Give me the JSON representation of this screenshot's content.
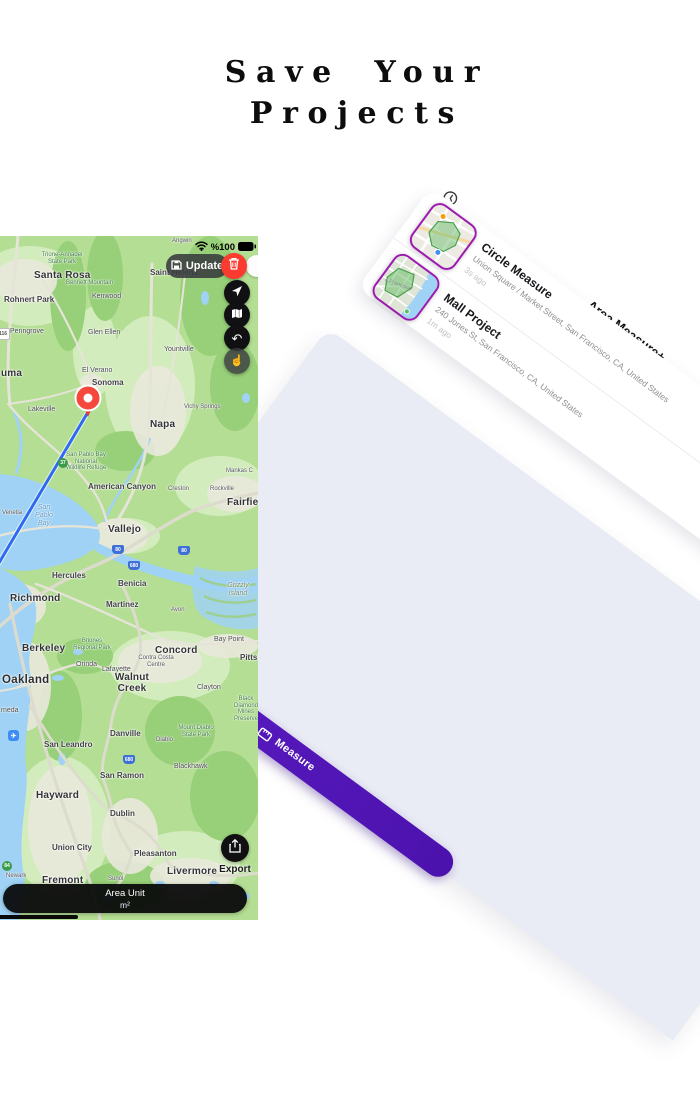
{
  "title": {
    "line1": "Save Your",
    "line2": "Projects"
  },
  "panel": {
    "title": "Area Measure+",
    "history_icon": "clock-history-icon",
    "tab_label": "Measure",
    "tab_icon": "ruler-icon",
    "accent_color": "#5d1ec9",
    "thumb_border_color": "#9c1ab1",
    "background_color": "#e9ebf5",
    "projects": [
      {
        "name": "Circle Measure",
        "address": "Union Square / Market Street, San Francisco, CA, United States",
        "time": "3s ago"
      },
      {
        "name": "Mall Project",
        "address": "240 Jones St, San Francisco, CA, United States",
        "time": "1m ago"
      }
    ]
  },
  "phone": {
    "status": {
      "battery_text": "%100",
      "wifi_icon": "wifi-icon",
      "battery_icon": "battery-full-icon"
    },
    "update_button": {
      "label": "Update",
      "icon": "save-icon"
    },
    "delete_button": {
      "icon": "trash-icon",
      "color": "#fb3b30"
    },
    "controls": [
      {
        "icon": "location-arrow-icon"
      },
      {
        "icon": "map-layers-icon"
      },
      {
        "icon": "undo-icon"
      },
      {
        "icon": "tap-gesture-icon"
      }
    ],
    "export_button": {
      "label": "Export",
      "icon": "share-export-icon"
    },
    "area_unit": {
      "label": "Area Unit",
      "value": "m²"
    },
    "pin_color": "#f5473c",
    "line_color": "#2e6bf0",
    "map_labels": [
      {
        "t": "Santa Rosa",
        "x": 34,
        "y": 34,
        "c": "city-lg"
      },
      {
        "t": "Trione-Annadel\nState Park",
        "x": 62,
        "y": 16,
        "c": "park ctr"
      },
      {
        "t": "Bennett Mountain",
        "x": 66,
        "y": 44,
        "c": "park"
      },
      {
        "t": "Rohnert Park",
        "x": 4,
        "y": 60,
        "c": "city"
      },
      {
        "t": "Kenwood",
        "x": 92,
        "y": 57,
        "c": "town"
      },
      {
        "t": "Penngrove",
        "x": 10,
        "y": 92,
        "c": "town"
      },
      {
        "t": "Glen Ellen",
        "x": 88,
        "y": 93,
        "c": "town"
      },
      {
        "t": "Saint Helena",
        "x": 150,
        "y": 33,
        "c": "city"
      },
      {
        "t": "Angwin",
        "x": 172,
        "y": 2,
        "c": "small"
      },
      {
        "t": "Yountville",
        "x": 164,
        "y": 110,
        "c": "town"
      },
      {
        "t": "El Verano",
        "x": 82,
        "y": 131,
        "c": "town"
      },
      {
        "t": "Sonoma",
        "x": 92,
        "y": 143,
        "c": "city"
      },
      {
        "t": "Lakeville",
        "x": 28,
        "y": 170,
        "c": "town"
      },
      {
        "t": "uma",
        "x": 1,
        "y": 132,
        "c": "city-lg"
      },
      {
        "t": "Napa",
        "x": 150,
        "y": 183,
        "c": "city-lg"
      },
      {
        "t": "Vichy Springs",
        "x": 184,
        "y": 168,
        "c": "small"
      },
      {
        "t": "San Pablo Bay\nNational\nWildlife Refuge",
        "x": 86,
        "y": 216,
        "c": "park ctr"
      },
      {
        "t": "American Canyon",
        "x": 88,
        "y": 247,
        "c": "city"
      },
      {
        "t": "Creston",
        "x": 168,
        "y": 250,
        "c": "small"
      },
      {
        "t": "Rockville",
        "x": 210,
        "y": 250,
        "c": "small"
      },
      {
        "t": "Mankas C",
        "x": 226,
        "y": 232,
        "c": "small"
      },
      {
        "t": "Fairfield",
        "x": 227,
        "y": 261,
        "c": "city-lg"
      },
      {
        "t": "San\nPablo\nBay",
        "x": 44,
        "y": 268,
        "c": "water ctr"
      },
      {
        "t": "Venetia",
        "x": 2,
        "y": 274,
        "c": "small"
      },
      {
        "t": "Vallejo",
        "x": 108,
        "y": 288,
        "c": "city-lg"
      },
      {
        "t": "Hercules",
        "x": 52,
        "y": 336,
        "c": "city"
      },
      {
        "t": "Benicia",
        "x": 118,
        "y": 344,
        "c": "city"
      },
      {
        "t": "Richmond",
        "x": 10,
        "y": 357,
        "c": "city-lg"
      },
      {
        "t": "Martinez",
        "x": 106,
        "y": 365,
        "c": "city"
      },
      {
        "t": "Avon",
        "x": 171,
        "y": 371,
        "c": "small"
      },
      {
        "t": "Grizzly\nIsland",
        "x": 238,
        "y": 346,
        "c": "area ctr"
      },
      {
        "t": "Bay Point",
        "x": 214,
        "y": 400,
        "c": "town"
      },
      {
        "t": "Berkeley",
        "x": 22,
        "y": 407,
        "c": "city-lg"
      },
      {
        "t": "Briones\nRegional Park",
        "x": 92,
        "y": 402,
        "c": "park ctr"
      },
      {
        "t": "Concord",
        "x": 155,
        "y": 409,
        "c": "city-lg"
      },
      {
        "t": "Pittsburg",
        "x": 240,
        "y": 418,
        "c": "city"
      },
      {
        "t": "Orinda",
        "x": 76,
        "y": 425,
        "c": "town"
      },
      {
        "t": "Lafayette",
        "x": 102,
        "y": 430,
        "c": "town"
      },
      {
        "t": "Contra Costa\nCentre",
        "x": 156,
        "y": 419,
        "c": "small ctr"
      },
      {
        "t": "Oakland",
        "x": 2,
        "y": 438,
        "c": "city-xl"
      },
      {
        "t": "Walnut\nCreek",
        "x": 132,
        "y": 436,
        "c": "city-lg ctr"
      },
      {
        "t": "Clayton",
        "x": 197,
        "y": 448,
        "c": "town"
      },
      {
        "t": "Black Diamond\nMines\nPreserve",
        "x": 246,
        "y": 460,
        "c": "park ctr"
      },
      {
        "t": "meda",
        "x": 1,
        "y": 471,
        "c": "town"
      },
      {
        "t": "Danville",
        "x": 110,
        "y": 494,
        "c": "city"
      },
      {
        "t": "Diablo",
        "x": 156,
        "y": 501,
        "c": "small"
      },
      {
        "t": "Mount Diablo\nState Park",
        "x": 196,
        "y": 489,
        "c": "park ctr"
      },
      {
        "t": "San Leandro",
        "x": 44,
        "y": 505,
        "c": "city"
      },
      {
        "t": "Blackhawk",
        "x": 174,
        "y": 527,
        "c": "town"
      },
      {
        "t": "San Ramon",
        "x": 100,
        "y": 536,
        "c": "city"
      },
      {
        "t": "Hayward",
        "x": 36,
        "y": 554,
        "c": "city-lg"
      },
      {
        "t": "Dublin",
        "x": 110,
        "y": 574,
        "c": "city"
      },
      {
        "t": "Union City",
        "x": 52,
        "y": 608,
        "c": "city"
      },
      {
        "t": "Pleasanton",
        "x": 134,
        "y": 614,
        "c": "city"
      },
      {
        "t": "Livermore",
        "x": 167,
        "y": 630,
        "c": "city-lg"
      },
      {
        "t": "Newark",
        "x": 6,
        "y": 637,
        "c": "small"
      },
      {
        "t": "Fremont",
        "x": 42,
        "y": 639,
        "c": "city-lg"
      },
      {
        "t": "Sunol",
        "x": 108,
        "y": 640,
        "c": "small"
      }
    ],
    "shields": [
      {
        "t": "116",
        "x": -4,
        "y": 92,
        "c": "white"
      },
      {
        "t": "37",
        "x": 58,
        "y": 222,
        "c": "green"
      },
      {
        "t": "80",
        "x": 112,
        "y": 309,
        "c": "blue"
      },
      {
        "t": "80",
        "x": 178,
        "y": 310,
        "c": "blue"
      },
      {
        "t": "680",
        "x": 128,
        "y": 325,
        "c": "blue"
      },
      {
        "t": "680",
        "x": 123,
        "y": 519,
        "c": "blue"
      },
      {
        "t": "84",
        "x": 2,
        "y": 625,
        "c": "green"
      },
      {
        "t": "✈",
        "x": 8,
        "y": 494,
        "c": "air"
      }
    ]
  }
}
